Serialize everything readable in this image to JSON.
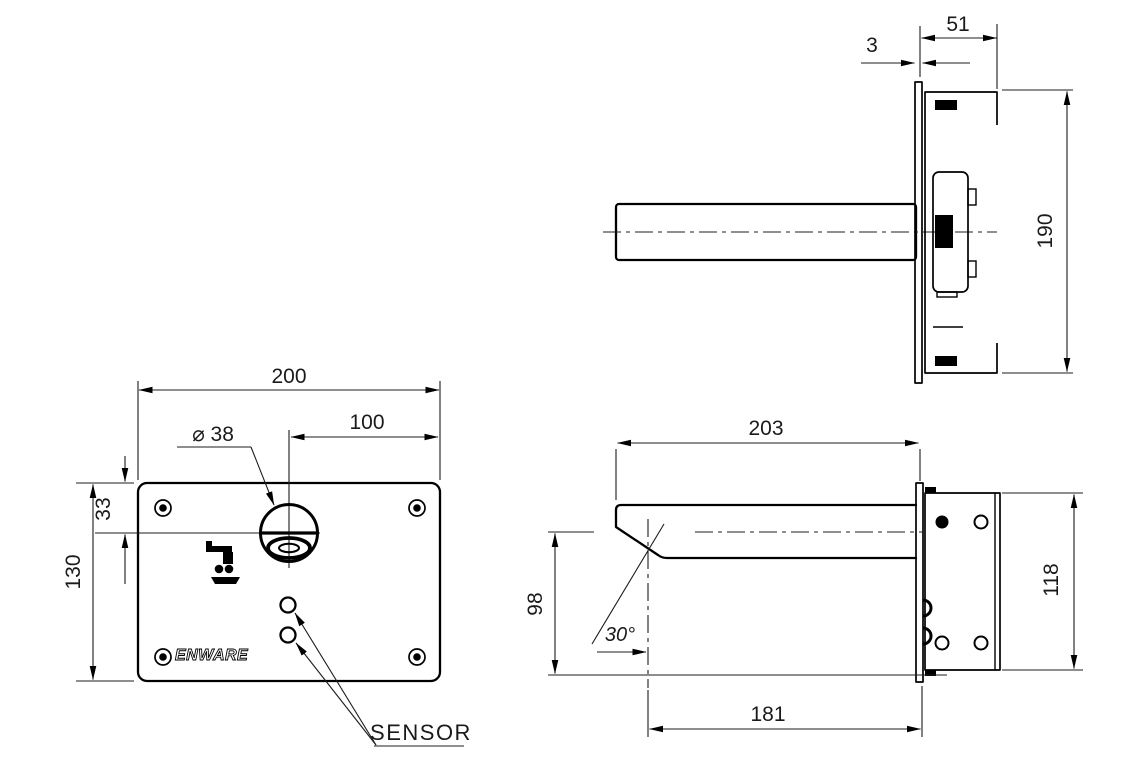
{
  "front_view": {
    "dim_width": "200",
    "dim_spout_offset": "100",
    "dim_spout_diameter": "⌀ 38",
    "dim_hole_top_offset": "33",
    "dim_height": "130",
    "brand_logo": "ENWARE",
    "sensor_label": "SENSOR"
  },
  "side_view_upper": {
    "dim_box_depth": "51",
    "dim_plate_thickness": "3",
    "dim_overall_height": "190"
  },
  "side_view_lower": {
    "dim_spout_length": "203",
    "dim_outlet_drop": "98",
    "dim_outlet_angle": "30°",
    "dim_bracket_height": "118",
    "dim_outlet_reach": "181"
  }
}
